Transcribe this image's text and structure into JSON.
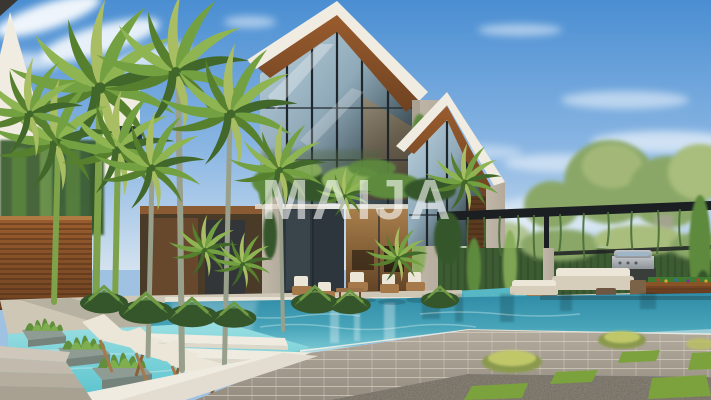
{
  "watermark": {
    "text": "MAIJA"
  },
  "scene": {
    "type": "architectural-rendering-photo",
    "setting": "modern tropical luxury villa with infinity pool at daytime",
    "objects": [
      "white gabled villa with full-height glass facade and wood soffit",
      "second smaller gabled wing with glass front",
      "concrete piers covered with ivy",
      "tall royal palm trees on the left",
      "wood slat privacy wall",
      "turquoise infinity pool with stone block retaining wall",
      "shallow water deck with three sun loungers and white platforms",
      "stone planters with grass tufts in the water",
      "patio armchairs with white cushions and coffee table",
      "black pergola with hanging vines over lounge area",
      "outdoor beige sofa set and wicker poufs",
      "stainless steel barbecue grill",
      "wooden billiard table with colored balls",
      "green hedge wall and background trees",
      "gravel terrace with square grass patches and yellow shrubs",
      "stone steps in the lower left corner",
      "blue sky with wispy clouds"
    ]
  },
  "palette": {
    "sky_top": "#4a8ed2",
    "sky_mid": "#8ab6e3",
    "sky_low": "#d3e2ef",
    "cloud": "#ffffff",
    "wall_white": "#f1ece1",
    "wall_shade": "#ddd5c6",
    "wood_soffit": "#9a5c2e",
    "wood_dark": "#6e4220",
    "glass_dark": "#2c363c",
    "glass_sky": "#bdd3e0",
    "interior_warm": "#8a6038",
    "concrete": "#b3aa9c",
    "ivy": "#5d8a3e",
    "ivy_dark": "#35562a",
    "ivy_light": "#86ad57",
    "hedge": "#3d5c33",
    "tree_bg": "#8aa768",
    "tree_light": "#a9bd7c",
    "pergola_black": "#1b1f22",
    "pool_deep": "#2f8ba6",
    "pool_mid": "#46a3b8",
    "pool_light": "#7fcbd6",
    "shallow_light": "#9adfe2",
    "coping_white": "#efebe0",
    "stone_wall": "#b2aa9d",
    "gravel": "#6e675c",
    "grass_patch": "#7ca23d",
    "deck": "#cfc7b6",
    "cushion_white": "#ece6d8",
    "wicker": "#7b6348",
    "chair_frame": "#a5794a",
    "billiard_wood": "#7b4a26",
    "billiard_felt": "#3f7a35",
    "grill_steel": "#c3c7cb",
    "trunk_green": "#7da24a",
    "trunk_gray": "#98a08c",
    "watermark_color": "#ffffff"
  }
}
